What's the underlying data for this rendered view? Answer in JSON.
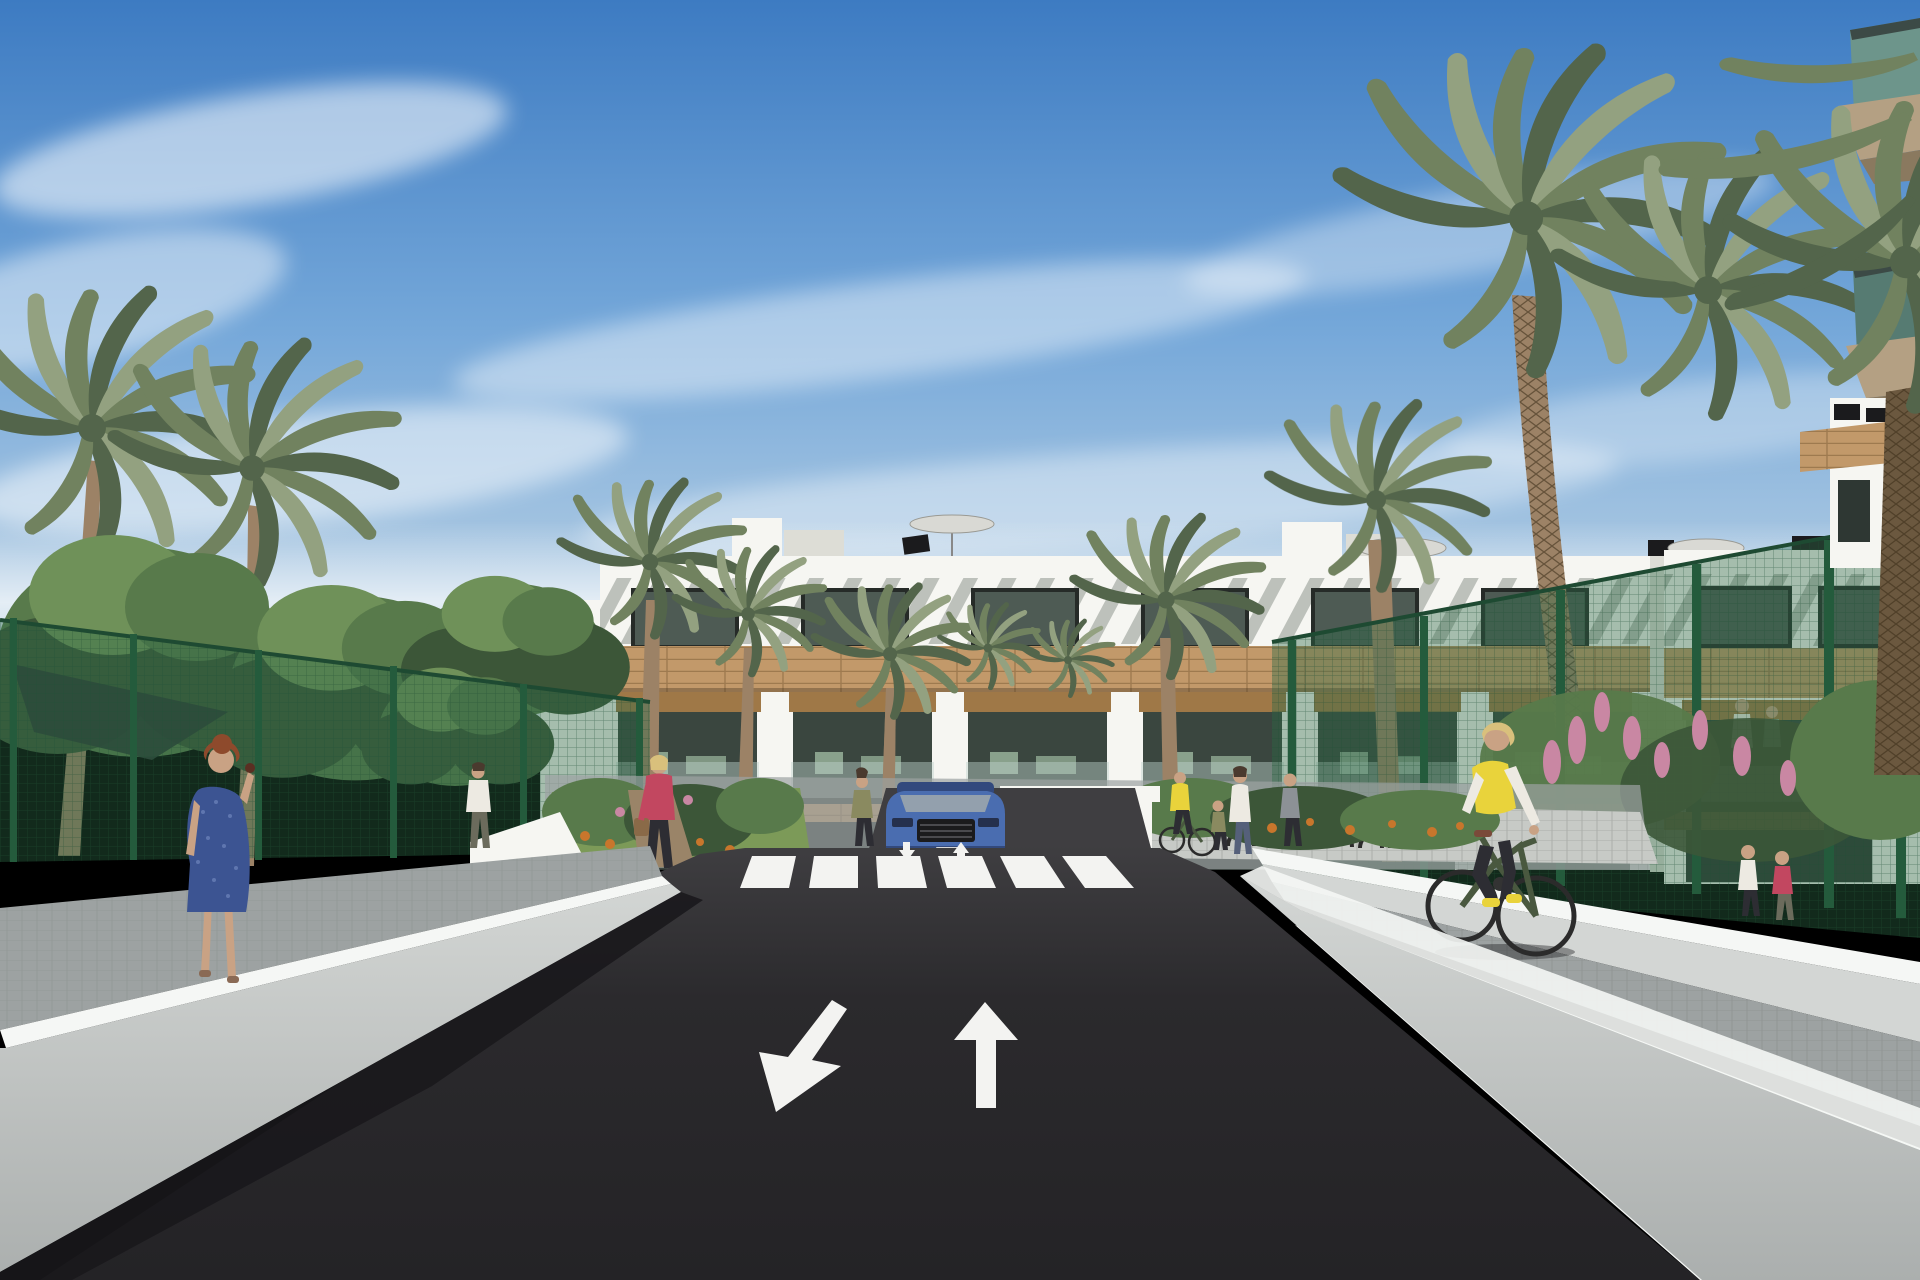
{
  "meta": {
    "title": "Residential complex exterior 3D rendering",
    "description": "Sunny daytime architectural visualization of a modern white Mediterranean apartment complex with palm trees, a central asphalt access road with pedestrian crossing and lane arrows, landscaped gardens, pedestrians and a cyclist"
  },
  "scene": {
    "setting": "3D render of a three-storey white apartment building complex behind a dark asphalt street flanked by white retaining walls, green mesh fences, gardens and date palms under a blue sky with wispy clouds",
    "sky": "clear blue sky with thin diagonal cirrus clouds, brighter haze near the horizon",
    "buildings": {
      "main_block": "white three-storey apartment row with rooftop pergola slats casting diagonal stripes, dark framed windows, tan wood-clad bands between floors, recessed balconies with wood pergolas and glass balustrades",
      "right_block": "matching white apartment wing on the right with residents on a balcony",
      "foreground_right": "close-up corner of a building at top right with teal glass balcony balustrades and tan slabs",
      "roof_items": "white stair boxes, gray patio umbrellas, dark solar panels and vents on the roof terraces"
    },
    "road": {
      "surface": "dark charcoal asphalt driveway leading to the building garage",
      "crosswalk_stripes": 6,
      "lane_arrows": [
        "down-left",
        "up"
      ],
      "small_arrows_near_crossing": [
        "down",
        "up"
      ],
      "left_edge": "white retaining wall with bright top cap and gray face, shadow cast on the asphalt",
      "right_edge": "white retaining walls with a gray paved cycle path between them"
    },
    "vehicles": {
      "car": "blue SUV seen head-on parked at the garage entrance ramp",
      "bicycle": "dark green city bicycle ridden by a woman in a yellow vest"
    },
    "people": {
      "woman_blue_dress": "red-haired woman in a patterned blue knee-length dress walking away on the left walkway holding a phone to her ear",
      "man_white_tshirt": "man in a white t-shirt and dark trousers walking on the left garden path",
      "woman_pink_jacket": "blonde woman in a pink jacket, dark trousers and brown handbag walking across the entrance path",
      "woman_entrance": "woman in an olive top standing near the car at the entrance",
      "cyclist_yellow_vest": "blonde woman cycling on the right path wearing a yellow vest, white sleeves and black leggings",
      "cyclist_near_building": "second cyclist in a yellow top near the bike racks",
      "woman_with_child": "woman with a small child standing by the bike racks",
      "right_path_pedestrians": "two pedestrians walking on the right-hand paved path",
      "balcony_residents": "small figures relaxing on the apartment balconies"
    },
    "vegetation": {
      "date_palms": 10,
      "fan_palm": 1,
      "deciduous_trees": "cluster of leafy green trees on the left behind the fence",
      "shade_sail": "dark shade sail between the left trees",
      "flowers": [
        "orange flower beds by the entrance gardens",
        "pink flower spikes behind the right fence"
      ],
      "fences": "dark green mesh fences with posts on both sides"
    }
  },
  "colors": {
    "sky_top": "#3D7BC2",
    "sky_mid": "#74A7D9",
    "sky_horizon": "#DCE7EC",
    "cloud": "#FFFFFF",
    "building_white": "#F6F6F2",
    "building_shadow": "#DDDDD6",
    "wood": "#C2996A",
    "wood_dark": "#9F7847",
    "glass_dark": "#3A463F",
    "glass_mid": "#4E5B54",
    "glass_ground": "#2E3733",
    "balcony_glass": "#BFD3CC",
    "furniture_sage": "#9DB8A0",
    "fg_glass": "#6D958B",
    "fg_glass_dark": "#567B72",
    "slab_tan": "#B4A083",
    "slab_shadow": "#8A795F",
    "road": "#2B2A2D",
    "road_far": "#3F3E41",
    "marking": "#F3F3F1",
    "wall_top": "#F5F7F5",
    "wall_face": "#D3D6D4",
    "wall_face_dark": "#ABAFAE",
    "path_gray": "#9DA2A2",
    "path_light": "#C7CAC6",
    "shadow": "#19181B",
    "palm_light": "#93A180",
    "palm_mid": "#71825F",
    "palm_dark": "#53654B",
    "trunk": "#9C8266",
    "trunk_dark": "#6B583F",
    "tree_dark": "#3C5638",
    "tree_mid": "#587A4B",
    "tree_light": "#6F9159",
    "fence_green": "#245B3C",
    "fence_mesh": "rgba(46,104,70,0.40)",
    "grass": "#7C9A58",
    "flower_orange": "#C8762C",
    "flower_pink": "#C987A3",
    "car_blue": "#4A6DB0",
    "car_blue_dark": "#32497D",
    "car_glass": "#93A0AD",
    "car_trim": "#1B1B1D",
    "skin": "#C9A284",
    "hair_red": "#8E4A2C",
    "hair_blonde": "#D9C07C",
    "hair_dark": "#4A3A2E",
    "dress_blue": "#3C5492",
    "jacket_pink": "#C24760",
    "vest_yellow": "#E9D33B",
    "shirt_white": "#EDEAE2",
    "pants_dark": "#2D2D33",
    "olive": "#8A8A60",
    "bag_brown": "#8A6A48",
    "umbrella": "#D9D9D4",
    "sail": "#2D3935",
    "soil": "#9A8468",
    "garage": "#141317",
    "door_green": "#3E5C48",
    "bike_frame": "#49583F",
    "metal_dark": "#2B2B2B",
    "window_frame": "#262B28"
  }
}
